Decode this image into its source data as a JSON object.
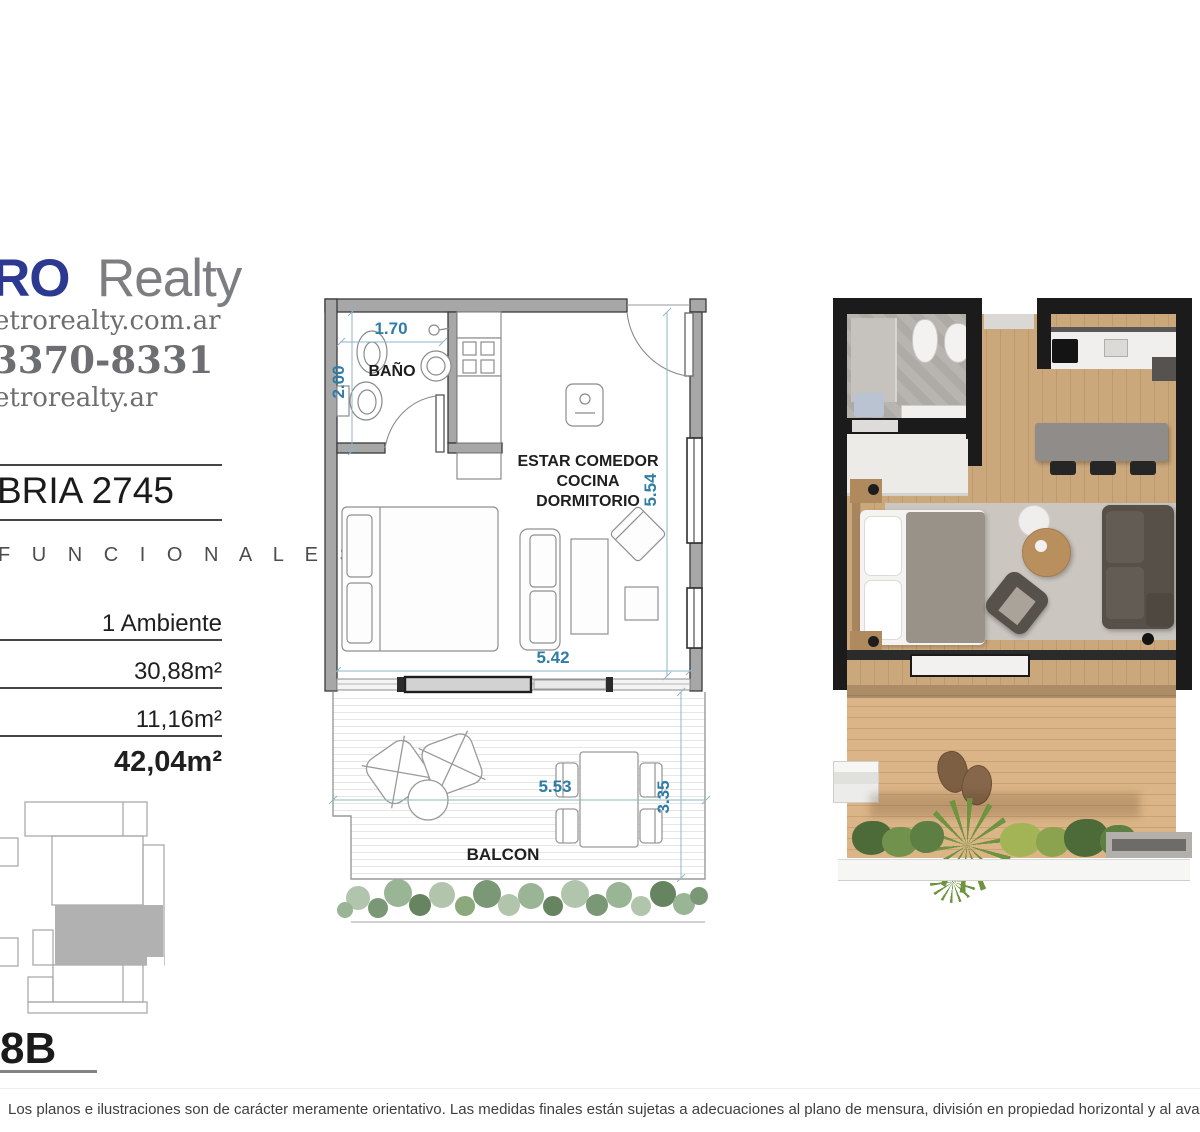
{
  "branding": {
    "logo_accent": "RO",
    "logo_rest": "Realty",
    "website": "etrorealty.com.ar",
    "phone": "3370-8331",
    "instagram": "etrorealty.ar"
  },
  "project": {
    "title": "BRIA 2745",
    "units_label": "F U N C I O N A L E S"
  },
  "unit": {
    "ambientes": "1 Ambiente",
    "area_covered": "30,88m²",
    "area_uncovered": "11,16m²",
    "area_total": "42,04m²",
    "code": "8B"
  },
  "plan": {
    "labels": {
      "bathroom": "BAÑO",
      "main_line1": "ESTAR COMEDOR",
      "main_line2": "COCINA",
      "main_line3": "DORMITORIO",
      "balcony": "BALCON"
    },
    "dims": {
      "bath_width": "1.70",
      "bath_depth": "2.00",
      "room_depth": "5.54",
      "room_width": "5.42",
      "balcony_width": "5.53",
      "balcony_depth": "3.35"
    }
  },
  "colors": {
    "logo_blue": "#2b3990",
    "dimension_blue": "#2f7ca6",
    "wall_gray": "#a7a7a7",
    "keyplan_unit_gray": "#b1b1b1"
  },
  "disclaimer": "Los planos e ilustraciones son de carácter meramente orientativo. Las medidas finales están sujetas a adecuaciones al plano de mensura, división en propiedad horizontal y al avance técnico del proyecto."
}
